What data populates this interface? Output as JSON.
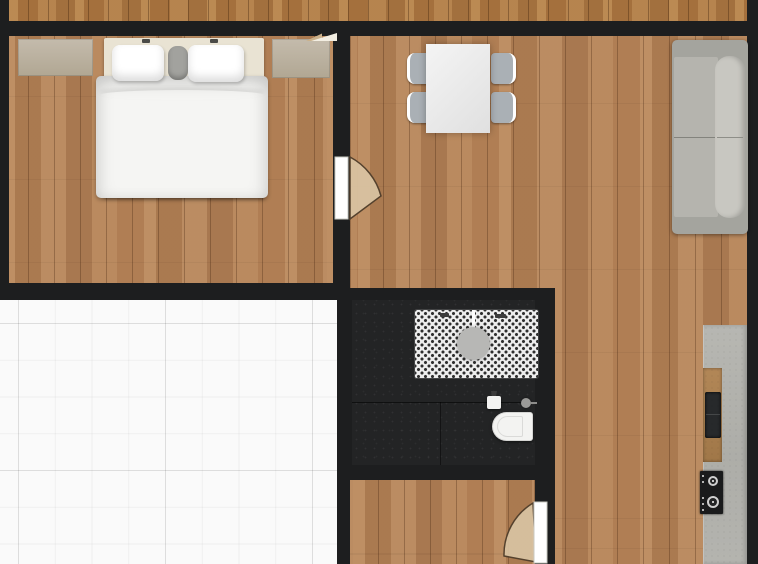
{
  "plan": {
    "type": "apartment-floor-plan-top-view",
    "rooms": [
      {
        "id": "bedroom",
        "floor": "wood",
        "furniture": [
          "double-bed",
          "pillow-left",
          "pillow-right",
          "bolster-cushion",
          "nightstand-left",
          "nightstand-right"
        ]
      },
      {
        "id": "living-dining",
        "floor": "wood",
        "furniture": [
          "dining-table",
          "dining-chair x4",
          "sofa"
        ]
      },
      {
        "id": "bathroom",
        "floor": "dark-tile",
        "furniture": [
          "shower-with-mosaic-tray",
          "drain",
          "wash-basin",
          "valve",
          "toilet"
        ]
      },
      {
        "id": "kitchen-strip",
        "floor": "wood",
        "furniture": [
          "countertop",
          "kitchen-sink",
          "gas-cooktop"
        ]
      },
      {
        "id": "hallway",
        "floor": "wood",
        "furniture": []
      },
      {
        "id": "terrace",
        "floor": "white-tile",
        "furniture": []
      },
      {
        "id": "balcony-strip",
        "floor": "wood",
        "furniture": []
      }
    ],
    "doors": [
      {
        "id": "bedroom-door",
        "state": "open",
        "swing": "into-living-room"
      },
      {
        "id": "hallway-door",
        "state": "open",
        "swing": "into-hallway"
      },
      {
        "id": "balcony-door",
        "state": "ajar",
        "swing": "into-living-room"
      }
    ],
    "palette": {
      "wall": "#1d1e1f",
      "wood_base": "#b5845a",
      "balcony_base": "#b07c46",
      "tile_white": "#fafafa",
      "bath_floor": "#232425",
      "shower_white": "#ededed",
      "fixture_white": "#f3f3f1",
      "counter": "#b2b2ad",
      "counter_wood": "#a87e52",
      "appliance_black": "#1a1b1c",
      "sofa_frame": "#a4a49e",
      "sofa_seat": "#b5b4ae",
      "sofa_back": "#c8c7c1",
      "chair_gray": "#aab0b5",
      "table_white": "#e9e9e9",
      "bed_frame": "#e9e3d3",
      "bed_white": "#f5f5f3",
      "nightstand": "#bcb2a2",
      "door_swing": "#d9c3a3"
    }
  }
}
